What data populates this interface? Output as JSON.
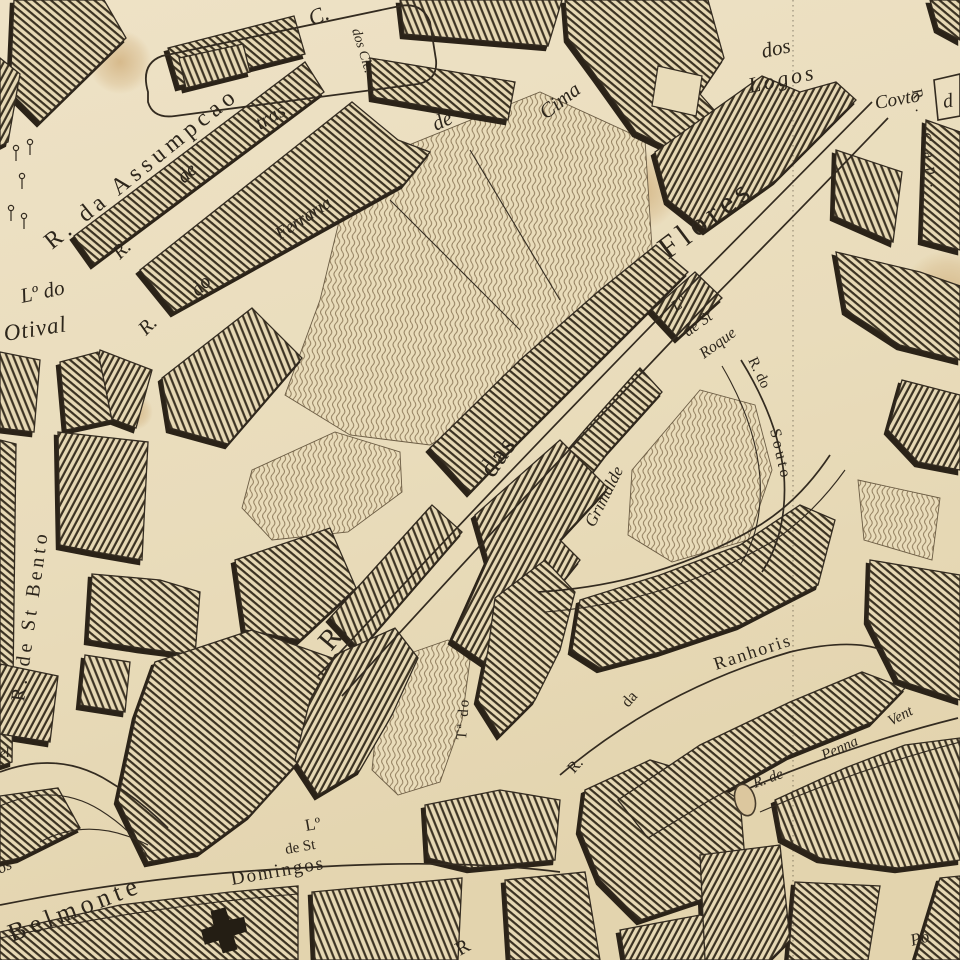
{
  "map_type": "antique engraved city street map",
  "palette": {
    "paper": "#ecdfc0",
    "paper_dark": "#e2d3ae",
    "ink": "#332b20",
    "hatch_line": "#3b3222",
    "block_shadow": "#2b2318",
    "field_line": "#8a7656",
    "stain": "#c49a5e"
  },
  "labels": {
    "c_abbrev": "C.",
    "dos_cle": "dos Cle.",
    "assumpcao": "R. da Assumpcao",
    "tras_r": "R.",
    "tras_de": "de",
    "tras_name": "tras",
    "ferr_r": "R.",
    "ferr_do": "do",
    "ferr_name": "Ferraria",
    "ferr_de": "de",
    "ferr_cima": "Cima",
    "logos_dos": "dos",
    "logos_name": "Logos",
    "covto": "Covto",
    "cov_d": "d",
    "r_cap": "R. Cap.",
    "flores_r": "R.",
    "flores_das": "das",
    "flores_name": "Flores",
    "roque_l1": "Lº",
    "roque_l2": "de St",
    "roque_l3": "Roque",
    "souto_rdo": "R. do",
    "souto_name": "Souto",
    "grimalde": "Grimalde",
    "otival_l1": "Lº do",
    "otival_l2": "Otival",
    "bento": "R. de St Bento",
    "ta_do": "Tª do",
    "ranh_r": "R.",
    "ranh_da": "da",
    "ranh_name": "Ranhoris",
    "penna_1": "R. de",
    "penna_2": "Penna",
    "penna_3": "Vent",
    "belmonte": "Belmonte",
    "dom_l1": "Lº",
    "dom_l2": "de St",
    "dom_l3": "Domingos",
    "edge_el": "el",
    "edge_os": "os",
    "edge_r": "R",
    "edge_po": "Po"
  }
}
